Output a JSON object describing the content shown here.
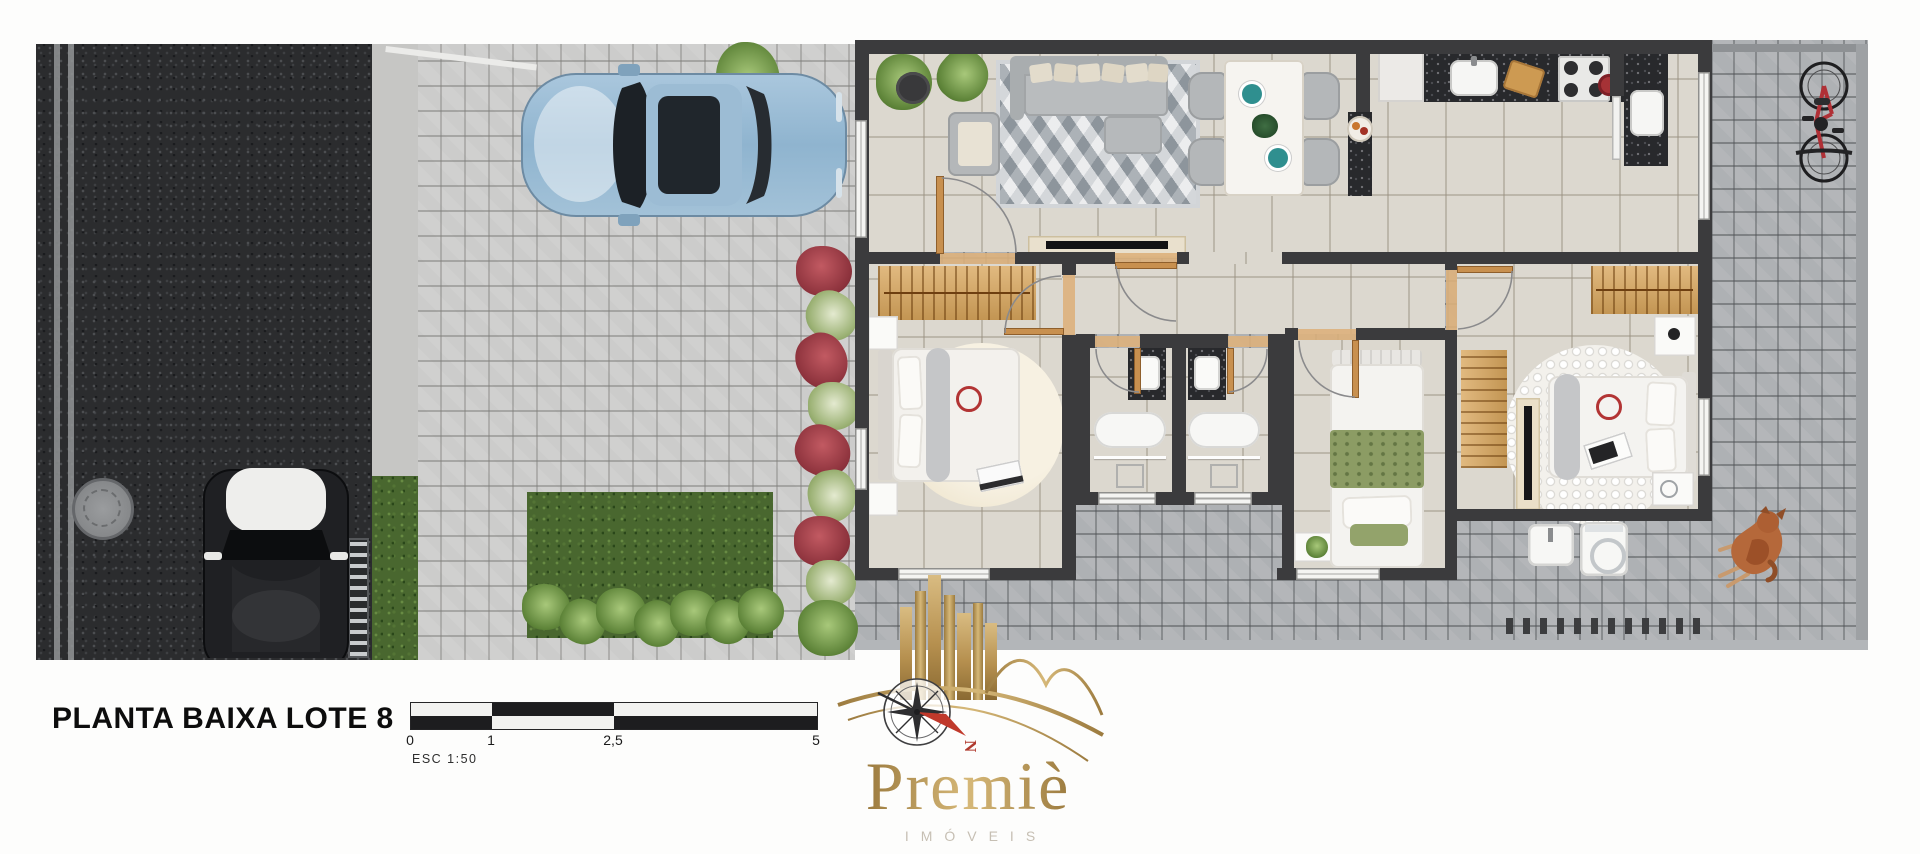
{
  "title": {
    "text": "PLANTA BAIXA LOTE 8"
  },
  "scale": {
    "labels": [
      "0",
      "1",
      "2,5",
      "5"
    ],
    "esc": "ESC 1:50"
  },
  "logo": {
    "brand": "Premiè",
    "subtitle": "IMÓVEIS",
    "north": "N"
  },
  "colors": {
    "brand_gold": "#b6904f",
    "asphalt": "#2b2c2e",
    "paver_light": "#cccccb",
    "paver_dark": "#aeb1b4",
    "grass": "#49672f",
    "floor_tile": "#dcd8cf",
    "wall": "#3b3b3d",
    "door_wood": "#c8904f",
    "wardrobe_wood": "#d9a65c",
    "car_blue": "#9fc0d8",
    "car_black": "#1b1c1e",
    "bicycle_red": "#b03036",
    "dog_brown": "#b5683a",
    "plant_red": "#a8434c",
    "compass_needle_red": "#c0392b"
  }
}
